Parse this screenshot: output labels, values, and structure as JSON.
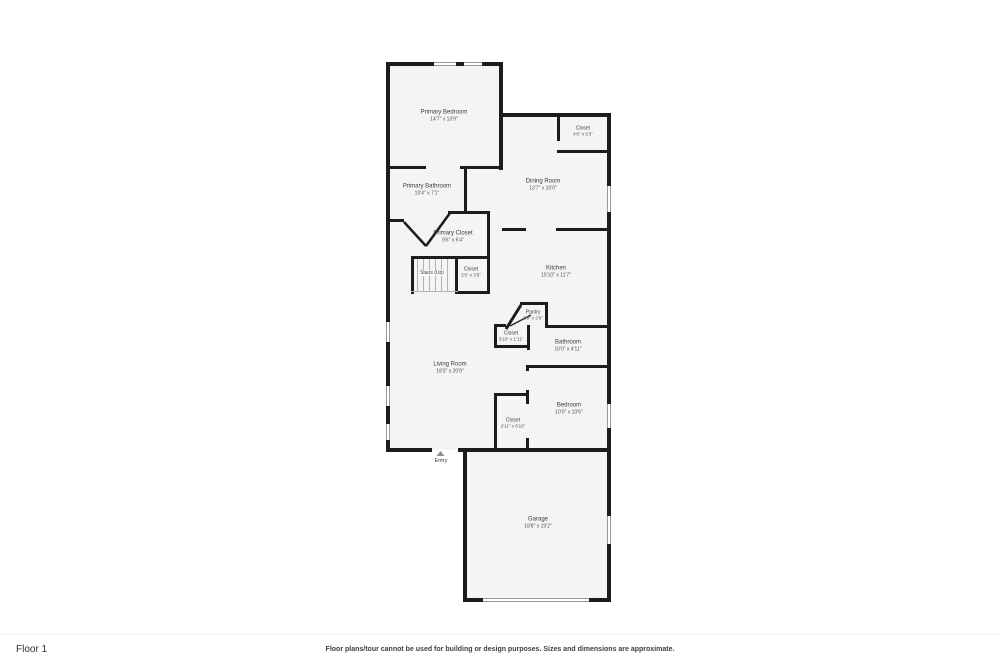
{
  "page": {
    "background": "#ffffff",
    "wall_color": "#1c1c1c",
    "room_fill": "#f4f4f4"
  },
  "floor_plan": {
    "rooms": [
      {
        "id": "primary-bedroom",
        "name": "Primary Bedroom",
        "dims": "14'7\" x 13'9\""
      },
      {
        "id": "closet-top-right",
        "name": "Closet",
        "dims": "4'6\" x 5'3\""
      },
      {
        "id": "dining-room",
        "name": "Dining Room",
        "dims": "13'7\" x 10'0\""
      },
      {
        "id": "primary-bathroom",
        "name": "Primary Bathroom",
        "dims": "10'4\" x 7'1\""
      },
      {
        "id": "primary-closet",
        "name": "Primary Closet",
        "dims": "9'6\" x 6'4\""
      },
      {
        "id": "stairs",
        "name": "Stairs (Up)",
        "dims": ""
      },
      {
        "id": "closet-stairs",
        "name": "Closet",
        "dims": "2'6\" x 3'5\""
      },
      {
        "id": "kitchen",
        "name": "Kitchen",
        "dims": "15'10\" x 11'7\""
      },
      {
        "id": "pantry",
        "name": "Pantry",
        "dims": "2'9\" x 2'6\""
      },
      {
        "id": "closet-hall",
        "name": "Closet",
        "dims": "3'10\" x 1'11\""
      },
      {
        "id": "bathroom",
        "name": "Bathroom",
        "dims": "10'0\" x 4'11\""
      },
      {
        "id": "living-room",
        "name": "Living Room",
        "dims": "18'3\" x 20'9\""
      },
      {
        "id": "closet-bedroom",
        "name": "Closet",
        "dims": "2'11\" x 6'10\""
      },
      {
        "id": "bedroom",
        "name": "Bedroom",
        "dims": "10'0\" x 10'6\""
      },
      {
        "id": "garage",
        "name": "Garage",
        "dims": "18'8\" x 19'2\""
      }
    ],
    "entry_label": "Entry"
  },
  "footer": {
    "floor_label": "Floor 1",
    "disclaimer": "Floor plans/tour cannot be used for building or design purposes. Sizes and dimensions are approximate."
  }
}
